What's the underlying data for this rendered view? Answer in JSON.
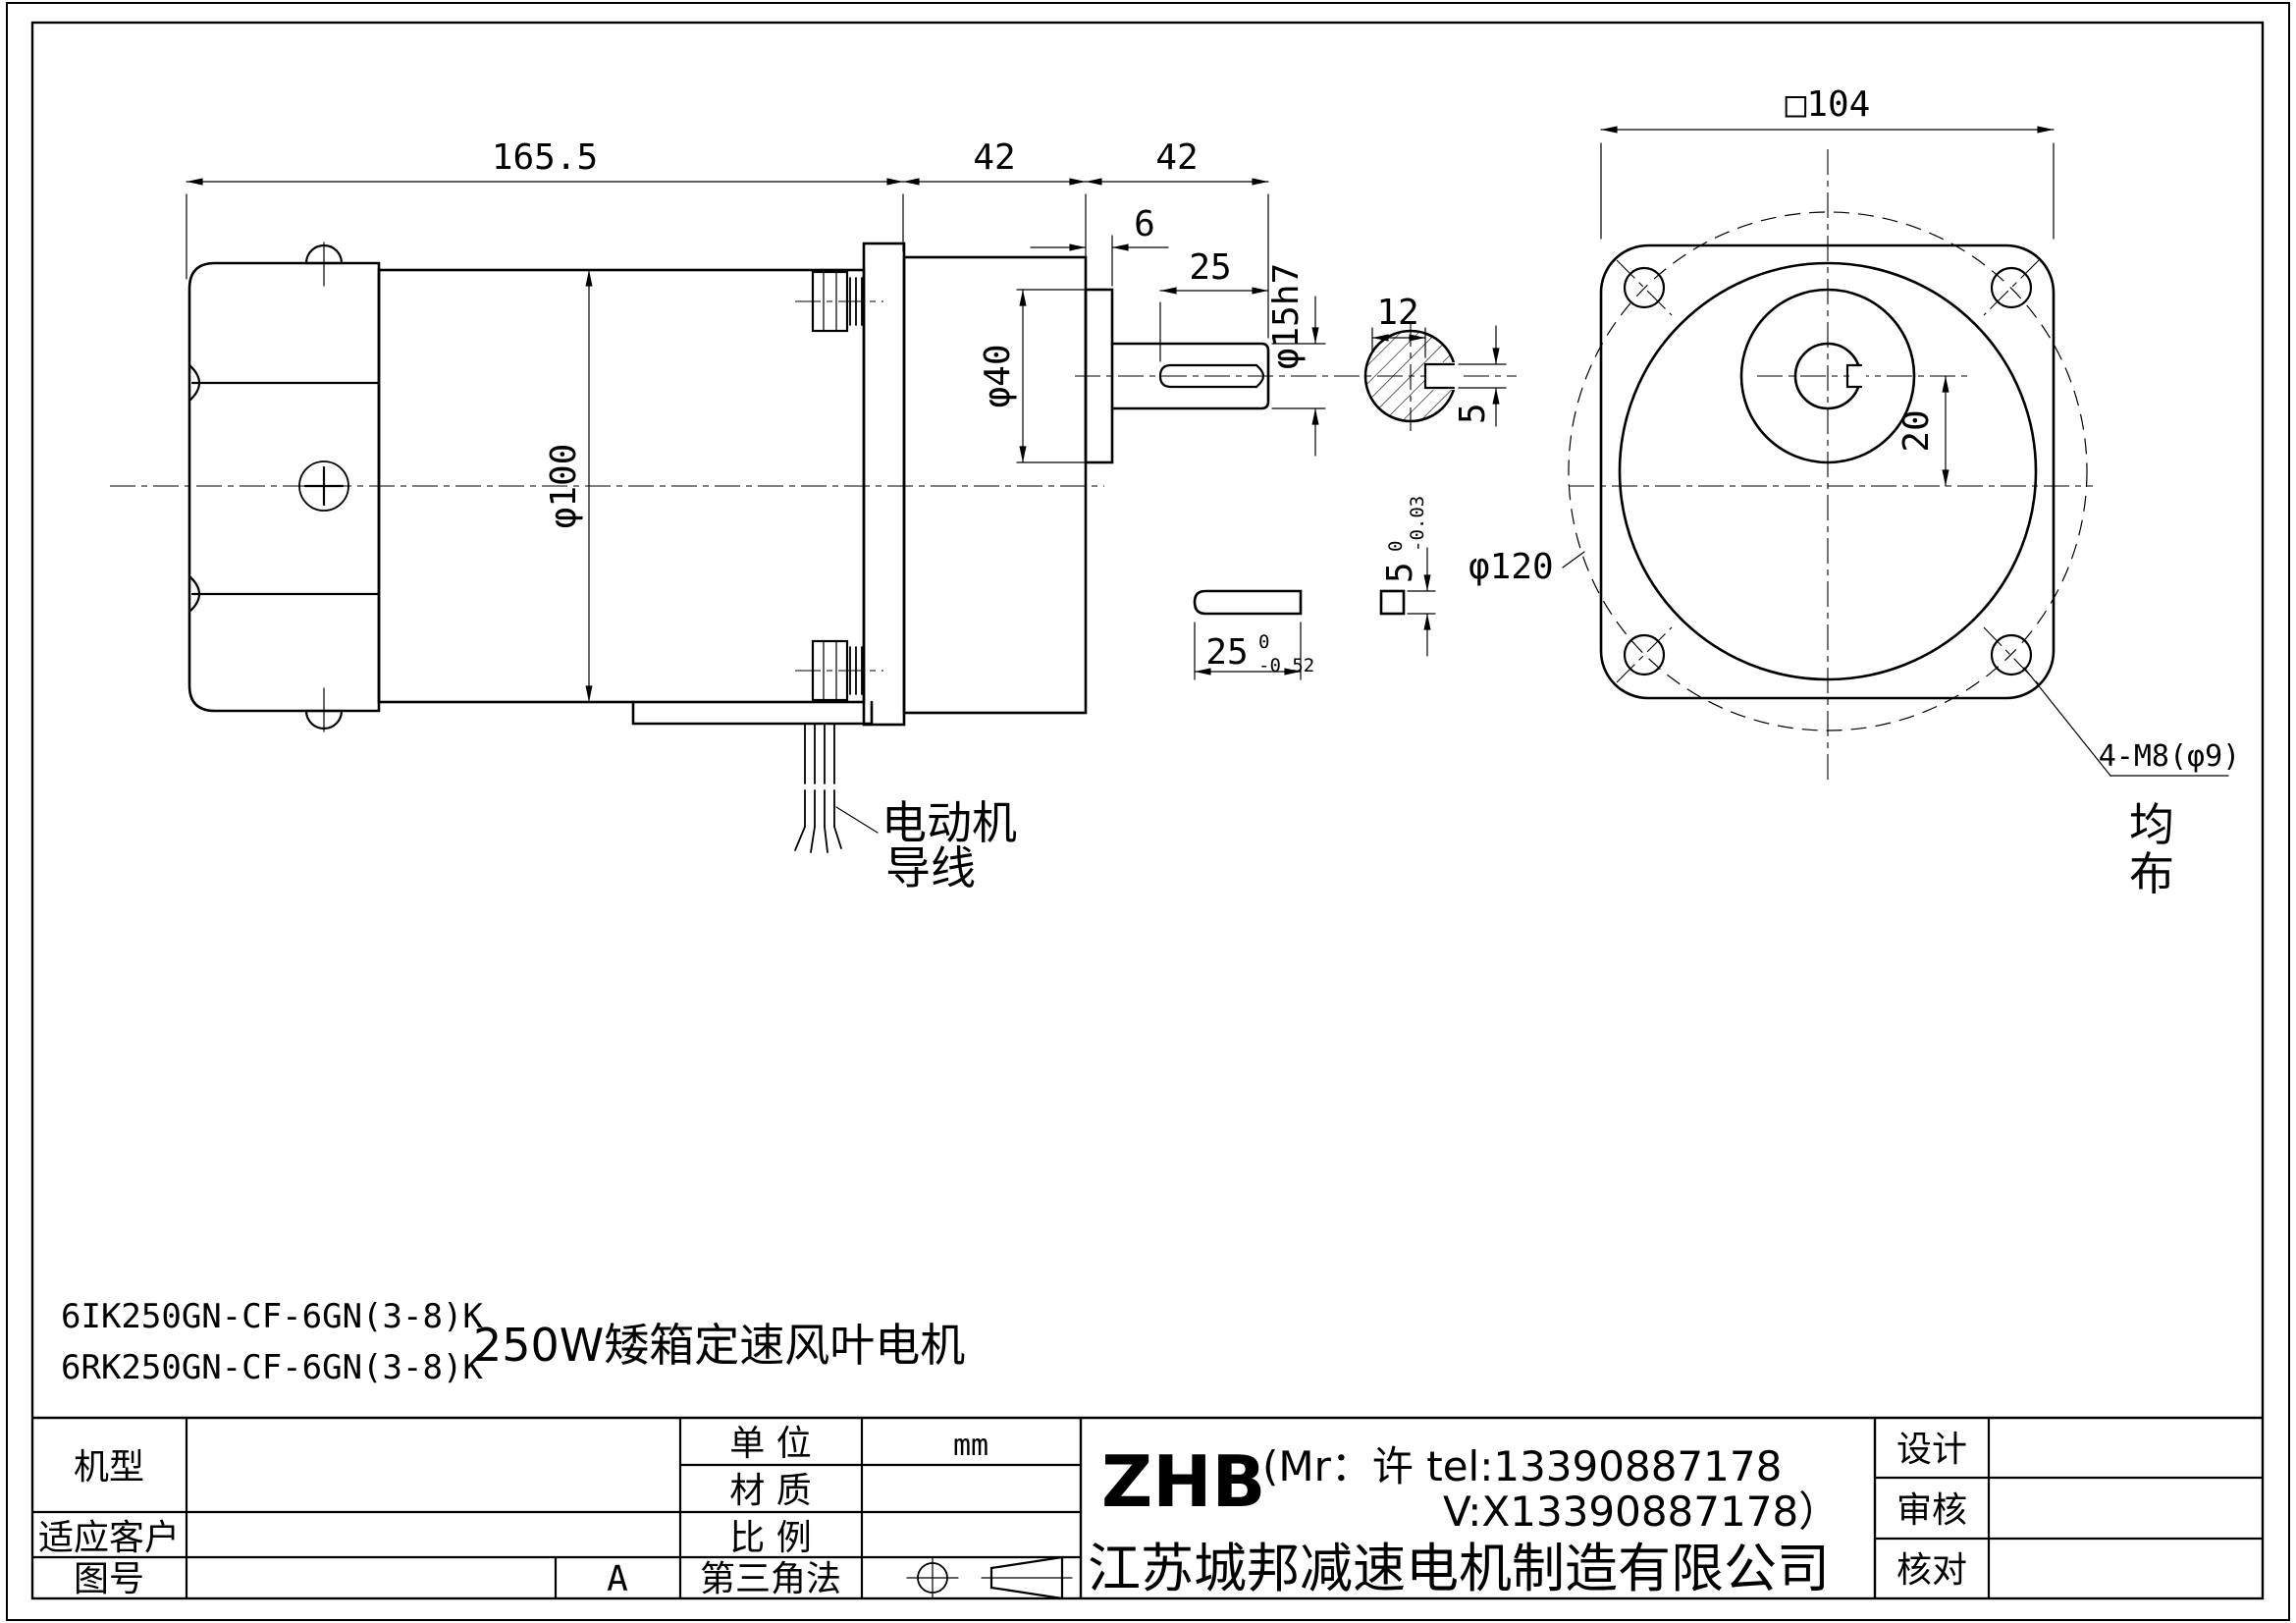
{
  "colors": {
    "ink": "#000000",
    "paper": "#ffffff"
  },
  "side_view": {
    "dim_overall": "165.5",
    "dim_gearbox": "42",
    "dim_shaft_ext": "42",
    "dim_boss_thk": "6",
    "dim_key_len": "25",
    "dim_boss_dia": "φ40",
    "dim_body_dia": "φ100",
    "dim_shaft_dia": "φ15h7",
    "wire_label_line1": "电动机",
    "wire_label_line2": "导线"
  },
  "shaft_section": {
    "dim_across": "12",
    "dim_key": "5"
  },
  "key_detail": {
    "dim_len": "25",
    "len_tol_upper": "0",
    "len_tol_lower": "-0.52",
    "dim_sq": "5",
    "sq_tol_upper": "0",
    "sq_tol_lower": "-0.03"
  },
  "front_view": {
    "dim_square": "□104",
    "dim_bolt_circle": "φ120",
    "dim_offset": "20",
    "holes_label": "4-M8(φ9)",
    "holes_note_line1": "均",
    "holes_note_line2": "布"
  },
  "notes": {
    "model_line1": "6IK250GN-CF-6GN(3-8)K",
    "model_line2": "6RK250GN-CF-6GN(3-8)K",
    "description": "250W矮箱定速风叶电机"
  },
  "title_block": {
    "model_label": "机型",
    "customer_label": "适应客户",
    "drawing_no_label": "图号",
    "rev": "A",
    "unit_label": "单  位",
    "unit_value": "mm",
    "material_label": "材  质",
    "scale_label": "比  例",
    "projection_label": "第三角法",
    "brand": "ZHB",
    "contact_line1": "(Mr：许 tel:13390887178",
    "contact_line2": "V:X13390887178）",
    "company": "江苏城邦减速电机制造有限公司",
    "design_label": "设计",
    "review_label": "审核",
    "check_label": "核对"
  }
}
